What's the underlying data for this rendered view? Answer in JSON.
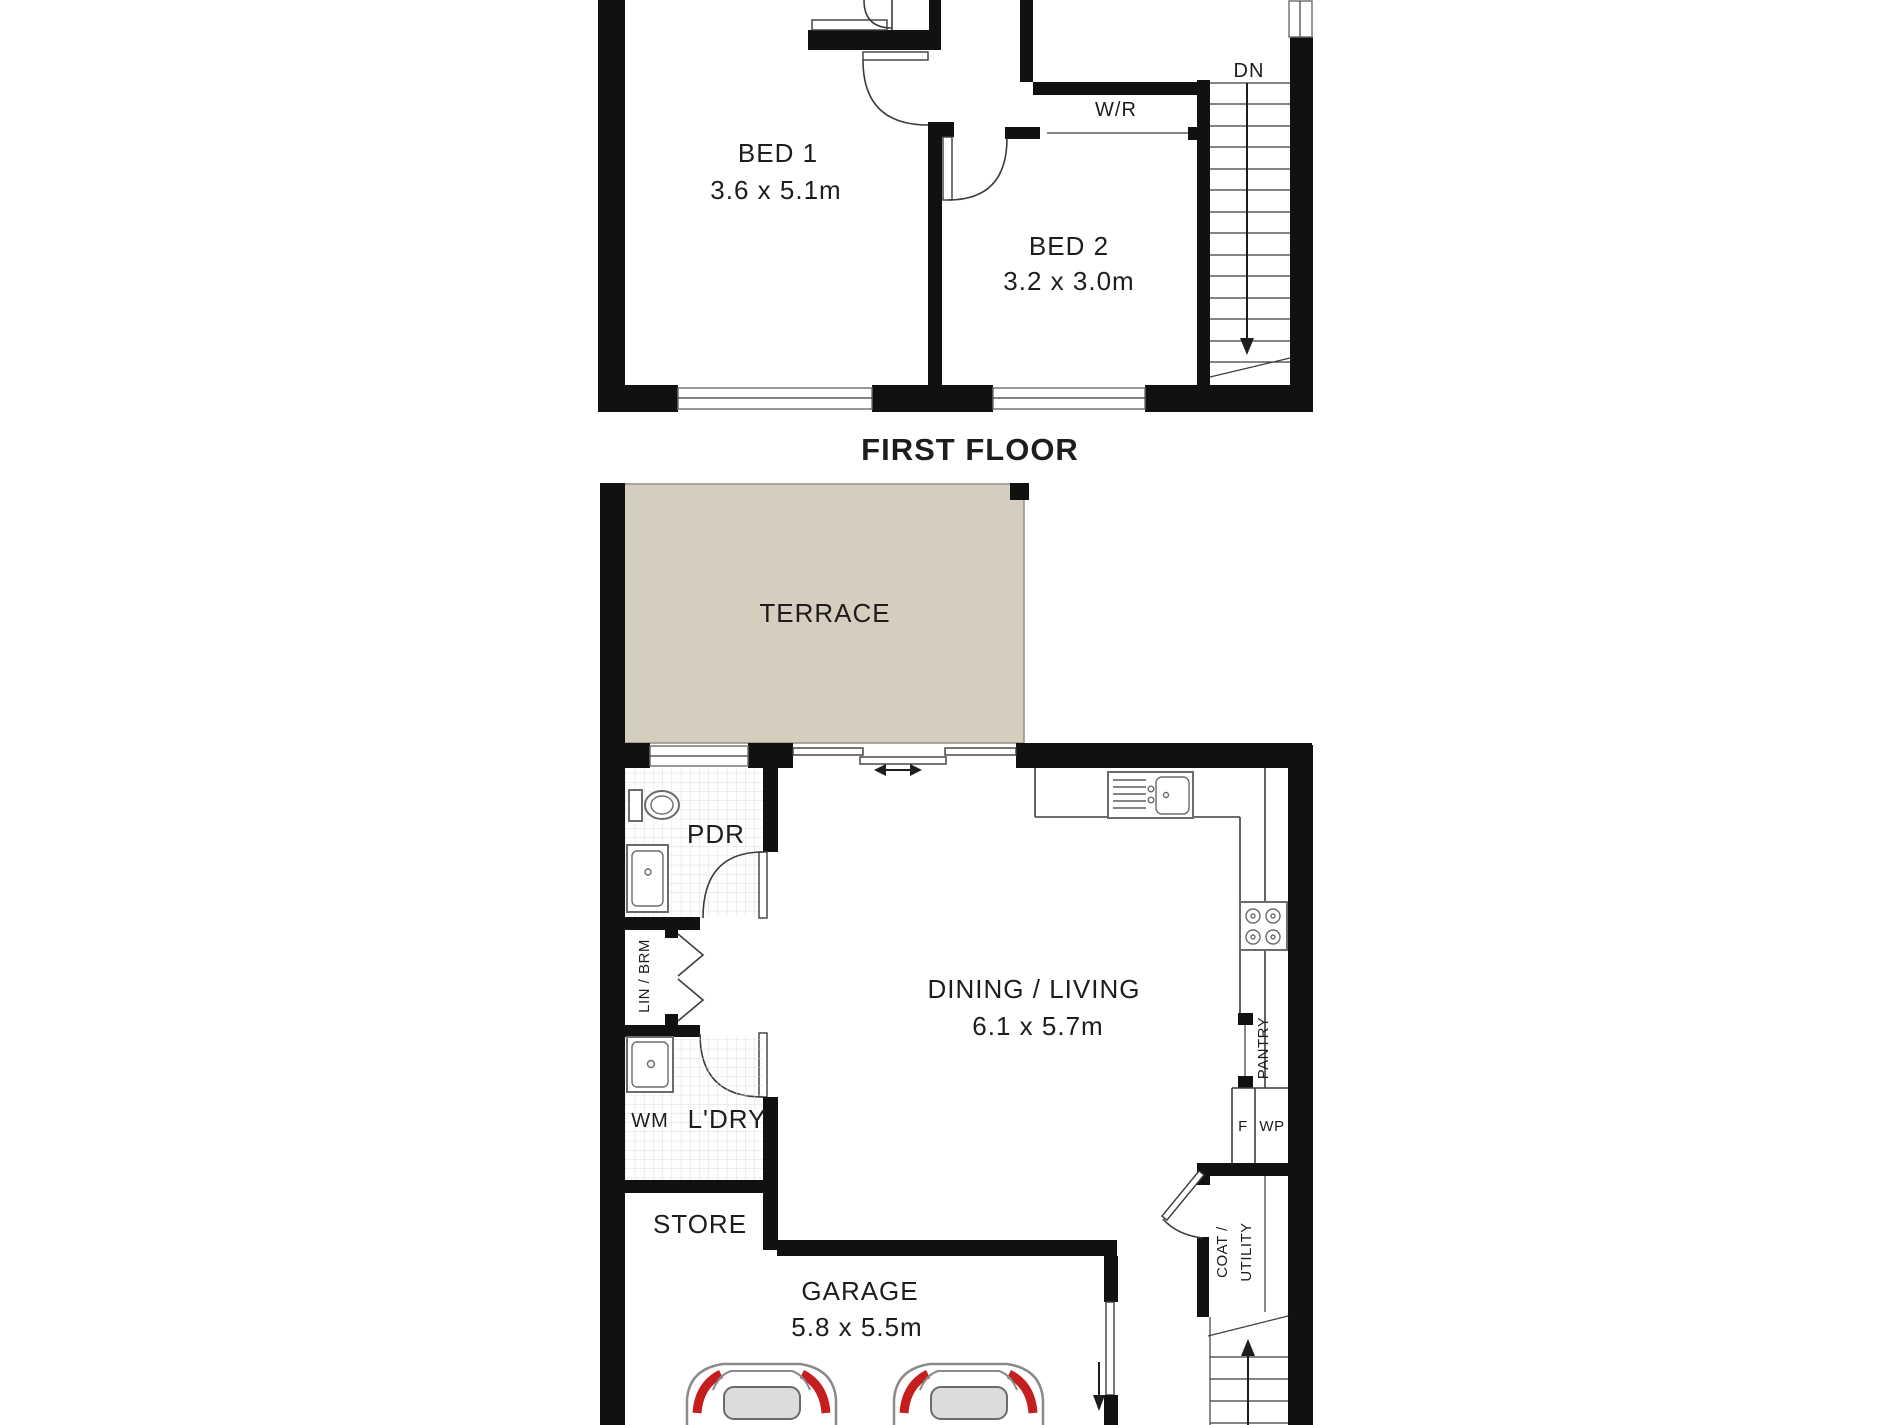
{
  "plan": {
    "first_floor": {
      "title": "FIRST FLOOR",
      "bed1": {
        "name": "BED 1",
        "dims": "3.6 x 5.1m"
      },
      "bed2": {
        "name": "BED 2",
        "dims": "3.2 x 3.0m"
      },
      "wardrobe": "W/R",
      "stairs_down": "DN"
    },
    "ground_floor": {
      "terrace": "TERRACE",
      "powder_room": "PDR",
      "linen_broom": "LIN / BRM",
      "washing_machine": "WM",
      "laundry": "L'DRY",
      "store": "STORE",
      "garage": {
        "name": "GARAGE",
        "dims": "5.8 x 5.5m"
      },
      "dining_living": {
        "name": "DINING / LIVING",
        "dims": "6.1 x 5.7m"
      },
      "pantry": "PANTRY",
      "fridge": "F",
      "water_point": "WP",
      "coat_line1": "COAT /",
      "coat_line2": "UTILITY"
    }
  },
  "colors": {
    "wall": "#111111",
    "line": "#3c3c3c",
    "tile": "#d8d8d8",
    "terrace_fill": "#d5cdbd",
    "terrace_edge": "#9a9488",
    "car_body": "#8a8a8a",
    "car_glass": "#dcdcdc",
    "accent_red": "#c41e1e",
    "text": "#1d1d1d"
  }
}
